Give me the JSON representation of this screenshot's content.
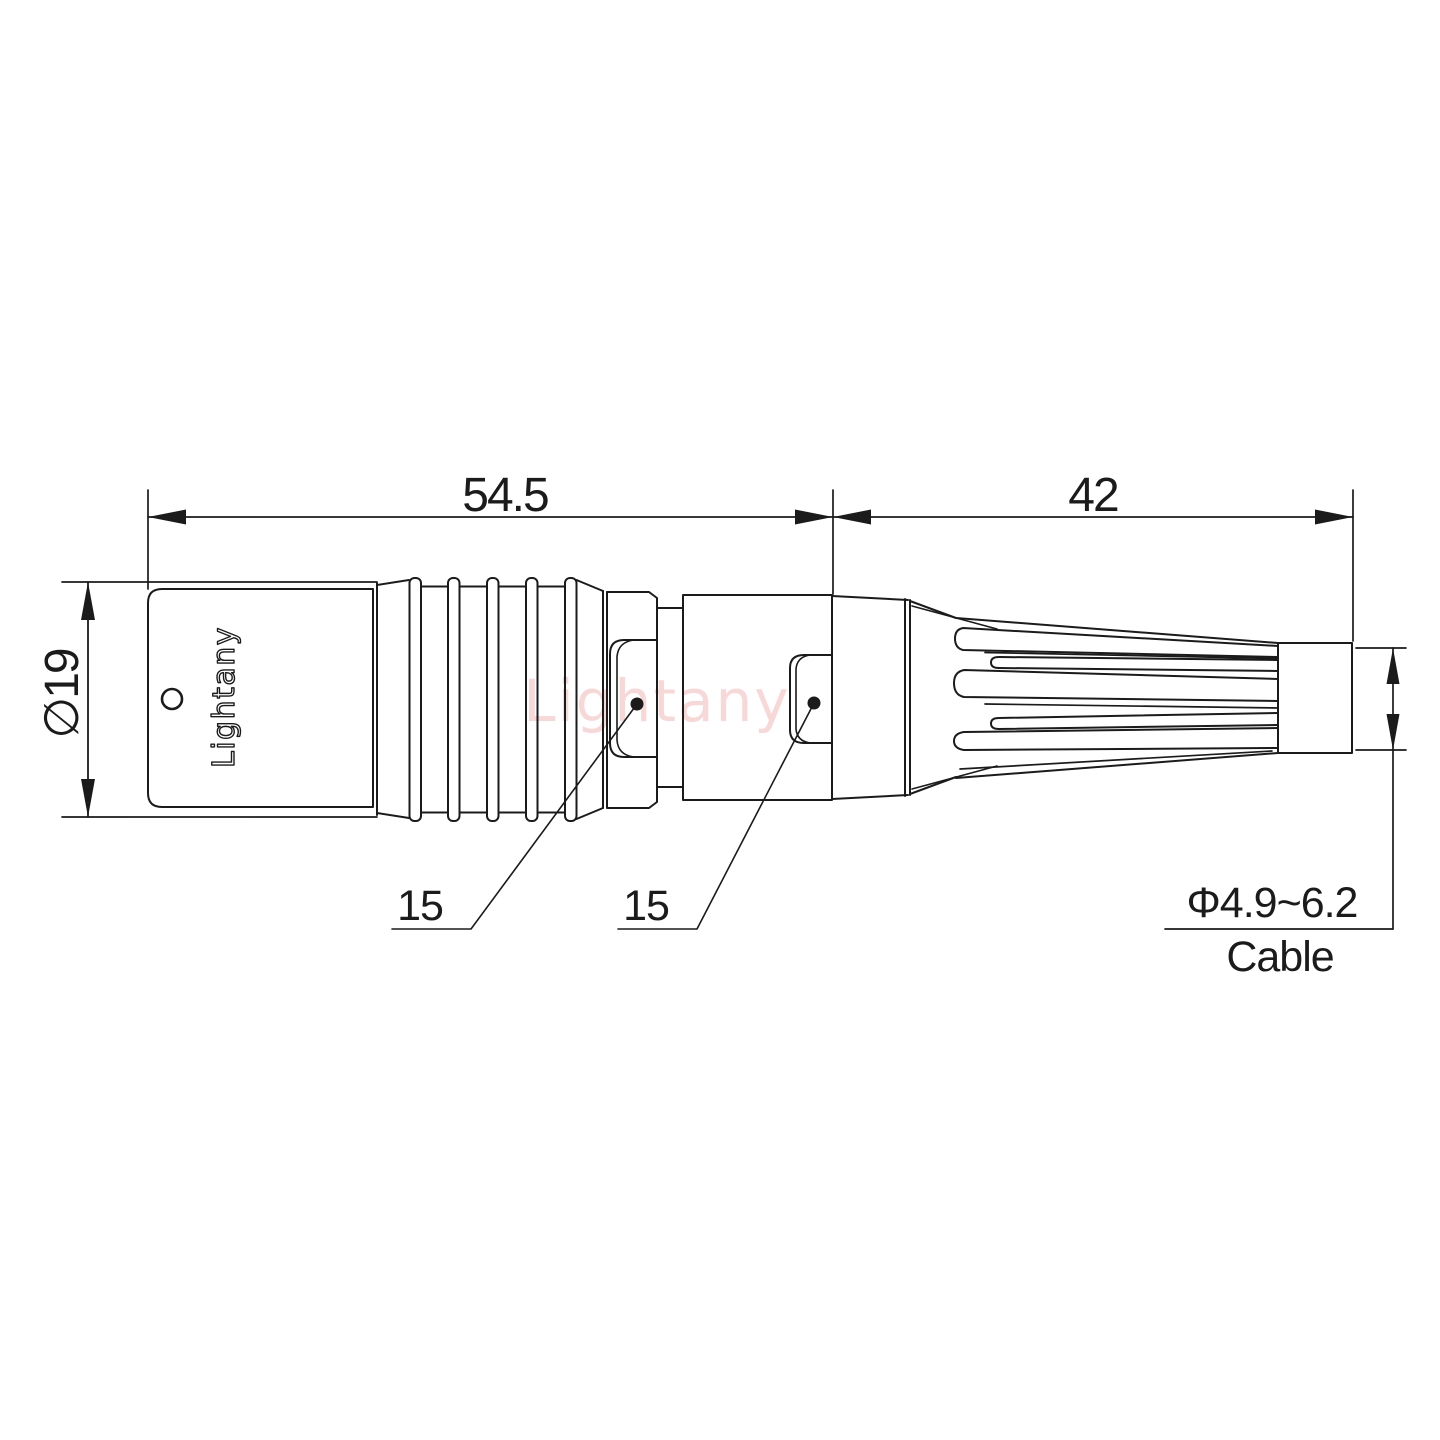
{
  "drawing": {
    "type": "connector-outline-technical-drawing",
    "labels": {
      "dim_front_length": "54.5",
      "dim_rear_length": "42",
      "dim_body_diameter": "∅19",
      "callout_front": "15",
      "callout_rear": "15",
      "cable_diameter_range": "Φ4.9~6.2",
      "cable_label": "Cable",
      "brand_engraving": "Lightany",
      "watermark": "Lightany"
    },
    "colors": {
      "line": "#1b1b1b",
      "background": "#ffffff",
      "watermark": "#f2b6b6"
    }
  }
}
